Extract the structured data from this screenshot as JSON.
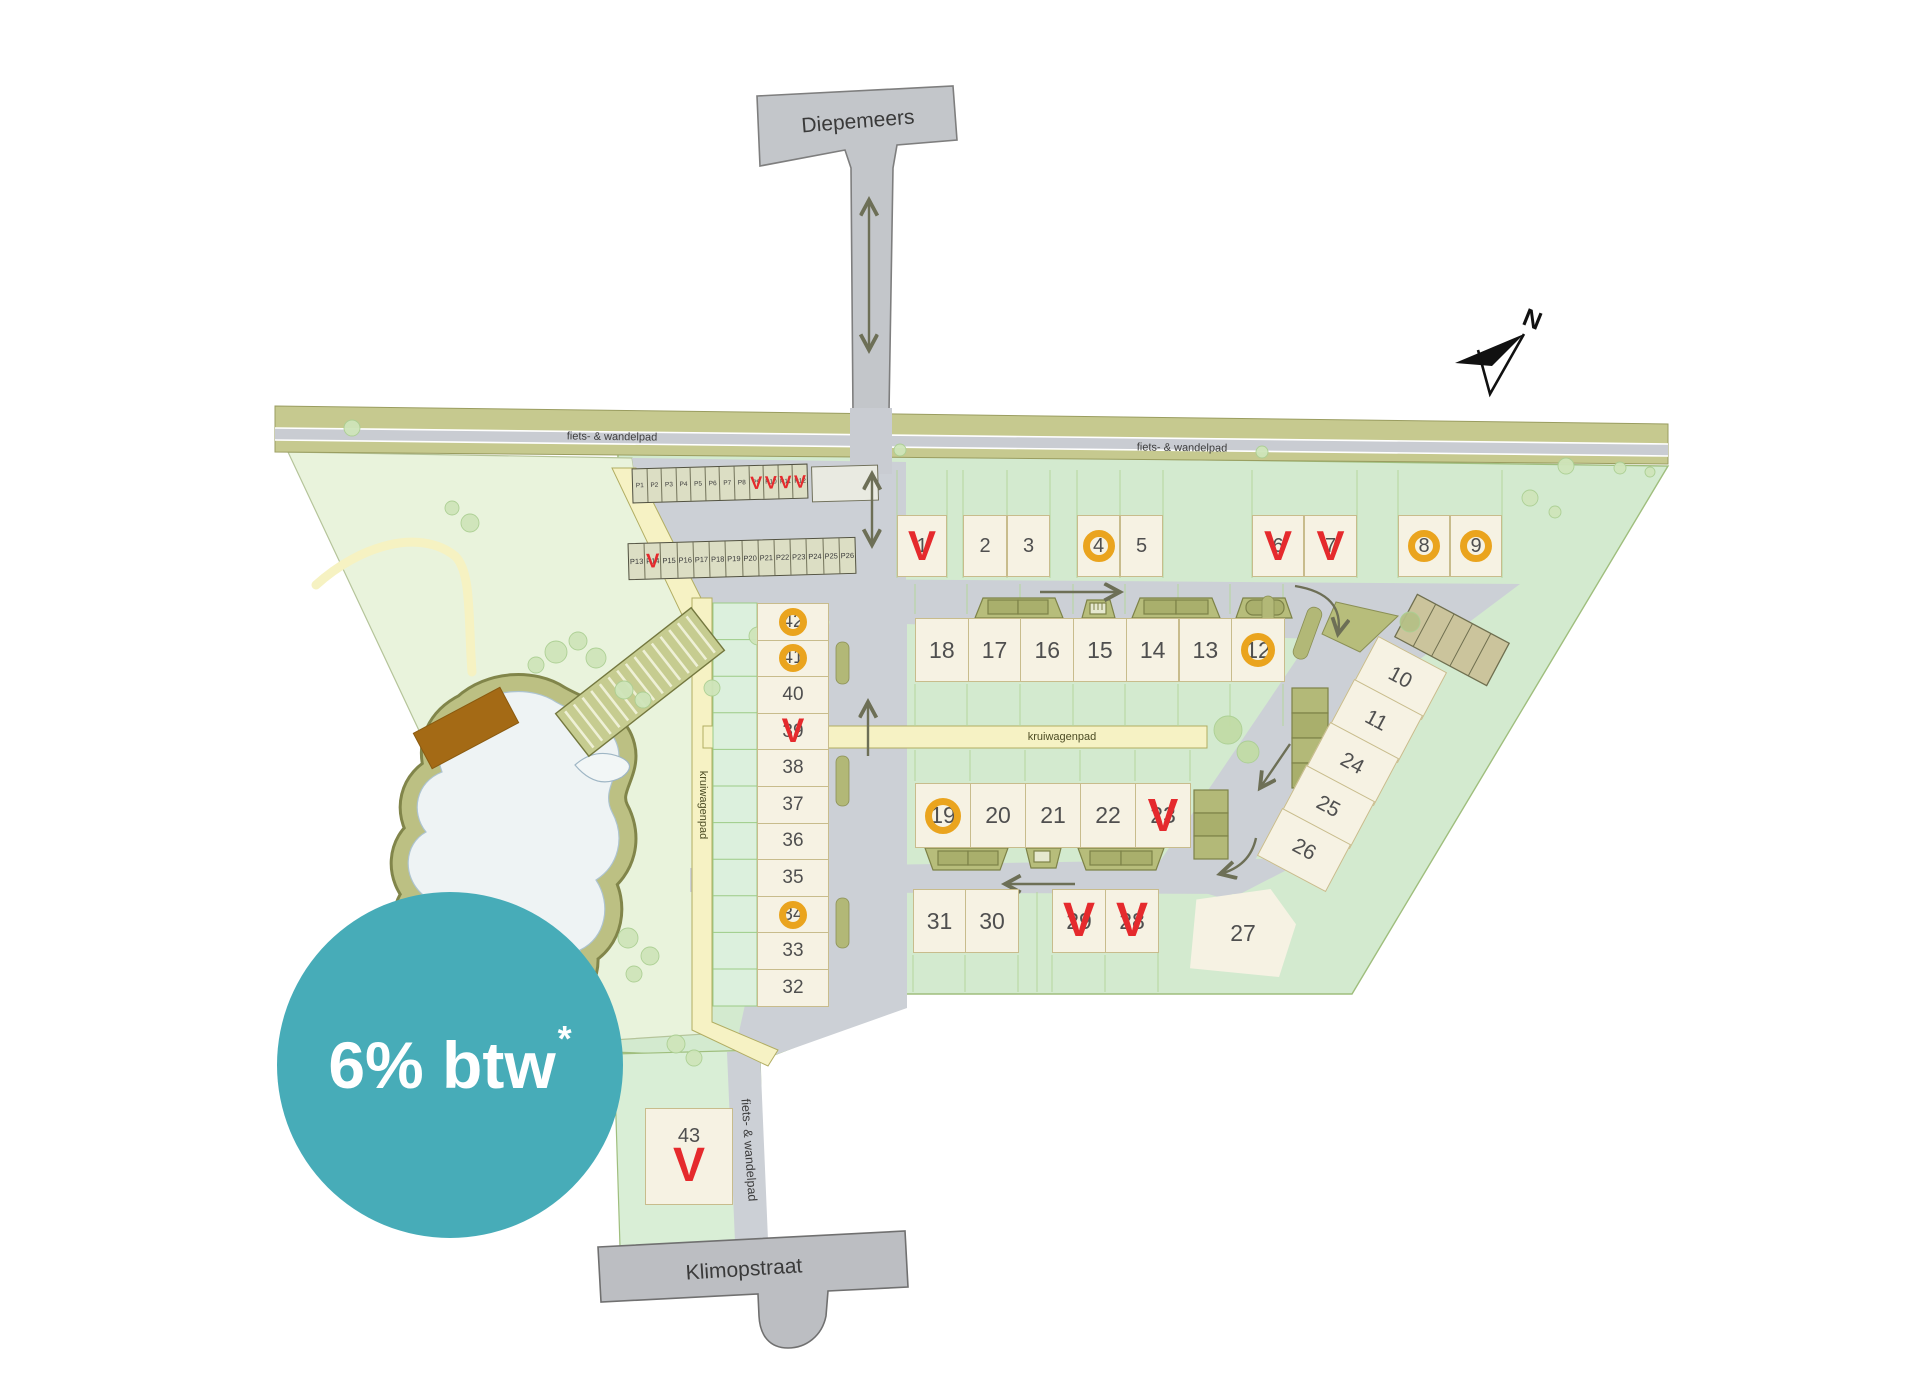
{
  "badge": {
    "text": "6% btw",
    "asterisk": "*",
    "color": "#47acb8"
  },
  "compass": {
    "label": "N"
  },
  "streets": {
    "top": "Diepemeers",
    "bottom": "Klimopstraat"
  },
  "path_labels": {
    "bike_left": "fiets- & wandelpad",
    "bike_right": "fiets- & wandelpad",
    "bike_bottom": "fiets- & wandelpad",
    "barrow_horizontal": "kruiwagenpad",
    "barrow_vertical": "kruiwagenpad"
  },
  "statuses": {
    "sold_symbol": "V",
    "sold_color": "#e52a2d",
    "option_symbol": "O",
    "option_color": "#eaa41e"
  },
  "parking": {
    "row1": {
      "spots": [
        "P1",
        "P2",
        "P3",
        "P4",
        "P5",
        "P6",
        "P7",
        "P8",
        "P9",
        "P10",
        "P11",
        "P12"
      ],
      "sold": [
        "P9",
        "P10",
        "P11",
        "P12"
      ]
    },
    "row2": {
      "spots": [
        "P13",
        "P14",
        "P15",
        "P16",
        "P17",
        "P18",
        "P19",
        "P20",
        "P21",
        "P22",
        "P23",
        "P24",
        "P25",
        "P26"
      ],
      "sold": [
        "P14"
      ]
    }
  },
  "lot_rows": {
    "top": [
      {
        "n": "1",
        "status": "sold"
      },
      {
        "n": "2",
        "status": "available"
      },
      {
        "n": "3",
        "status": "available"
      },
      {
        "n": "4",
        "status": "option"
      },
      {
        "n": "5",
        "status": "available"
      },
      {
        "n": "6",
        "status": "sold"
      },
      {
        "n": "7",
        "status": "sold"
      },
      {
        "n": "8",
        "status": "option"
      },
      {
        "n": "9",
        "status": "option"
      }
    ],
    "middle": [
      {
        "n": "18",
        "status": "available"
      },
      {
        "n": "17",
        "status": "available"
      },
      {
        "n": "16",
        "status": "available"
      },
      {
        "n": "15",
        "status": "available"
      },
      {
        "n": "14",
        "status": "available"
      },
      {
        "n": "13",
        "status": "available"
      },
      {
        "n": "12",
        "status": "option"
      }
    ],
    "court": [
      {
        "n": "19",
        "status": "option"
      },
      {
        "n": "20",
        "status": "available"
      },
      {
        "n": "21",
        "status": "available"
      },
      {
        "n": "22",
        "status": "available"
      },
      {
        "n": "23",
        "status": "sold"
      }
    ],
    "south": [
      {
        "n": "31",
        "status": "available"
      },
      {
        "n": "30",
        "status": "available"
      },
      {
        "n": "29",
        "status": "sold"
      },
      {
        "n": "28",
        "status": "sold"
      },
      {
        "n": "27",
        "status": "available"
      }
    ],
    "west": [
      {
        "n": "42",
        "status": "option"
      },
      {
        "n": "41",
        "status": "option"
      },
      {
        "n": "40",
        "status": "available"
      },
      {
        "n": "39",
        "status": "sold"
      },
      {
        "n": "38",
        "status": "available"
      },
      {
        "n": "37",
        "status": "available"
      },
      {
        "n": "36",
        "status": "available"
      },
      {
        "n": "35",
        "status": "available"
      },
      {
        "n": "34",
        "status": "option"
      },
      {
        "n": "33",
        "status": "available"
      },
      {
        "n": "32",
        "status": "available"
      }
    ],
    "east_diagonal": [
      {
        "n": "10",
        "status": "available"
      },
      {
        "n": "11",
        "status": "available"
      },
      {
        "n": "24",
        "status": "available"
      },
      {
        "n": "25",
        "status": "available"
      },
      {
        "n": "26",
        "status": "available"
      }
    ],
    "solo": [
      {
        "n": "43",
        "status": "sold"
      }
    ]
  }
}
